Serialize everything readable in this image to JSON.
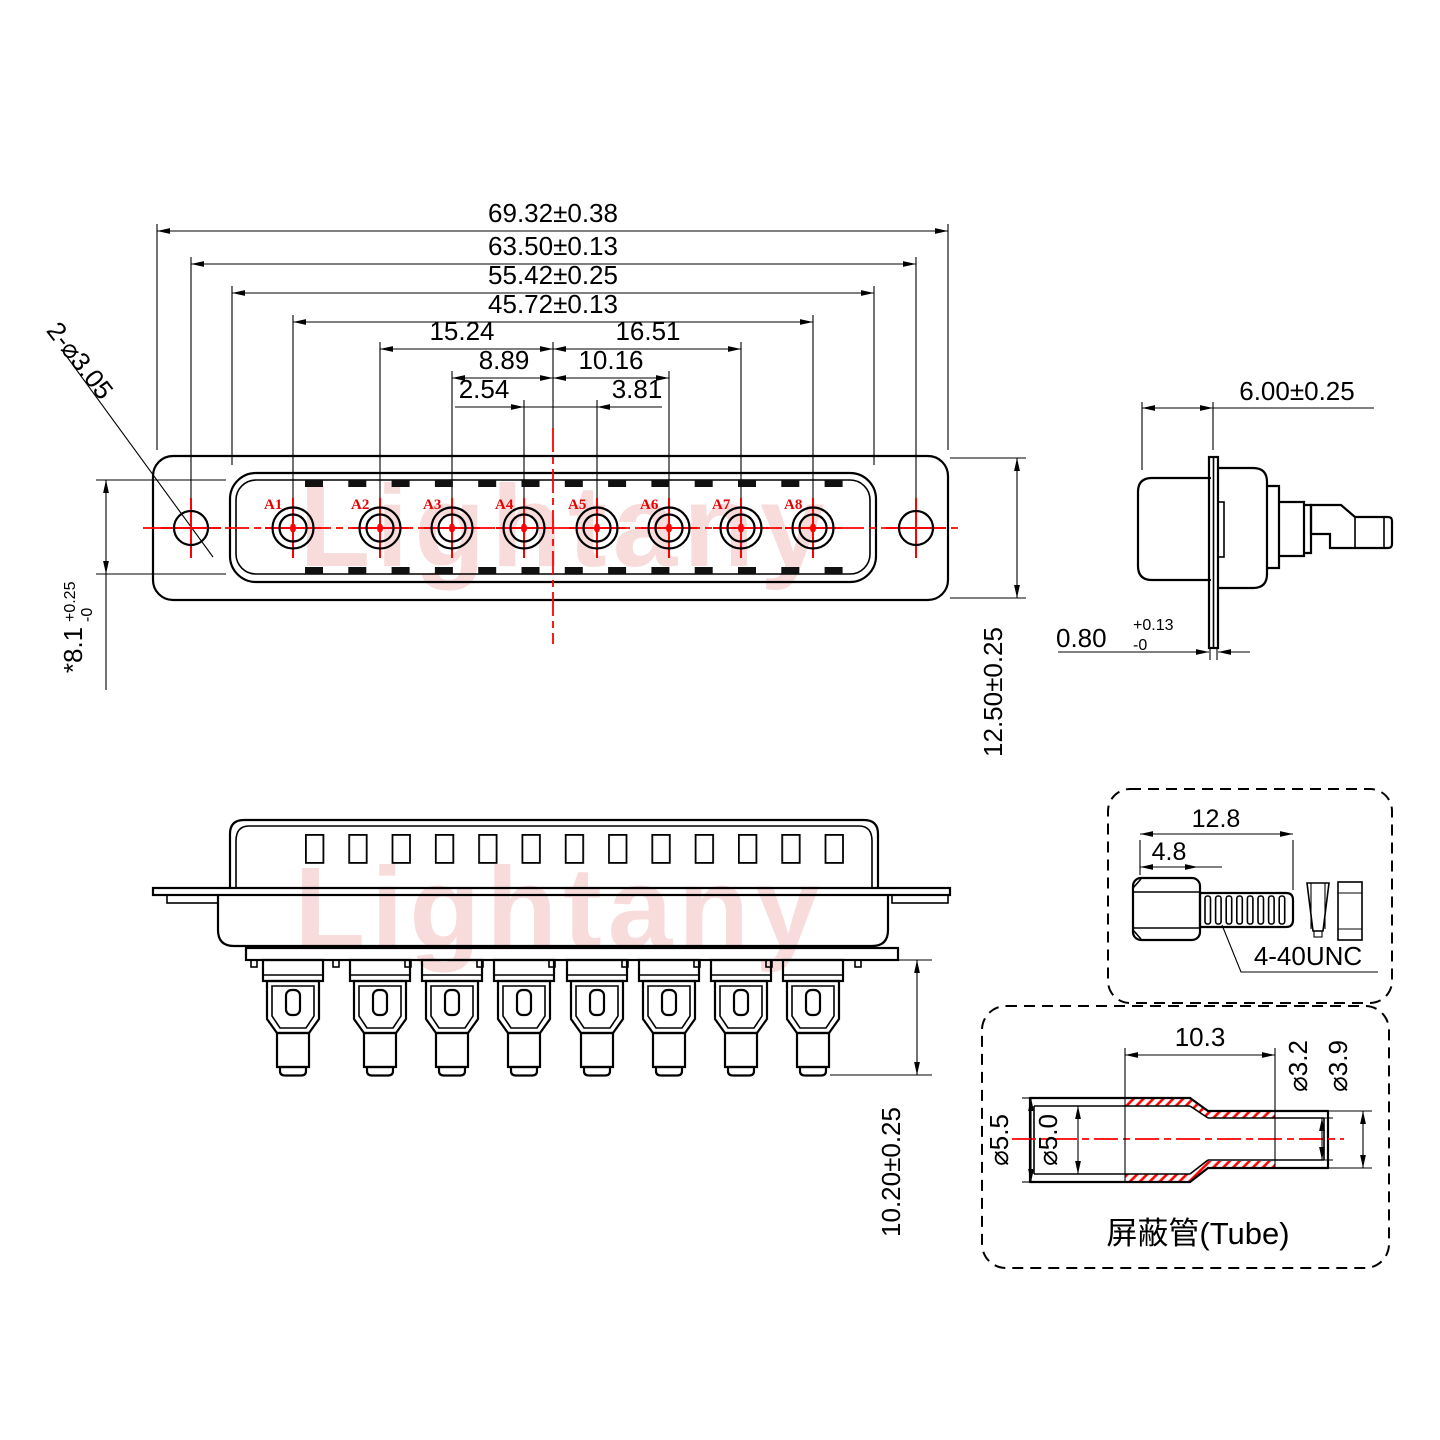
{
  "watermark": {
    "text": "Lightany"
  },
  "colors": {
    "accent": "#ff0000",
    "line": "#000000",
    "watermark": "#f2b9b9"
  },
  "front_view": {
    "dims": {
      "overall_width": "69.32±0.38",
      "hole_span": "63.50±0.13",
      "shell_width": "55.42±0.25",
      "contact_span": "45.72±0.13",
      "a2_to_center": "15.24",
      "center_to_a7": "16.51",
      "a3_to_center": "8.89",
      "center_to_a6": "10.16",
      "a4_to_center": "2.54",
      "center_to_a5": "3.81",
      "flange_height": "12.50±0.25",
      "shell_height": "*8.1",
      "shell_height_tol_up": "+0.25",
      "shell_height_tol_dn": "-0",
      "mounting_holes": "2-⌀3.05"
    },
    "contacts": [
      "A1",
      "A2",
      "A3",
      "A4",
      "A5",
      "A6",
      "A7",
      "A8"
    ]
  },
  "side_view": {
    "dims": {
      "front_depth": "6.00±0.25",
      "flange_thickness": "0.80",
      "flange_tol_up": "+0.13",
      "flange_tol_dn": "-0"
    }
  },
  "rear_view": {
    "dims": {
      "pot_length": "10.20±0.25"
    }
  },
  "screw_detail": {
    "dims": {
      "overall_length": "12.8",
      "head_length": "4.8"
    },
    "thread_label": "4-40UNC"
  },
  "tube_detail": {
    "dims": {
      "shrink_length": "10.3",
      "small_inner_dia": "⌀3.2",
      "small_outer_dia": "⌀3.9",
      "big_outer_dia": "⌀5.5",
      "big_inner_dia": "⌀5.0"
    },
    "label": "屏蔽管(Tube)"
  }
}
